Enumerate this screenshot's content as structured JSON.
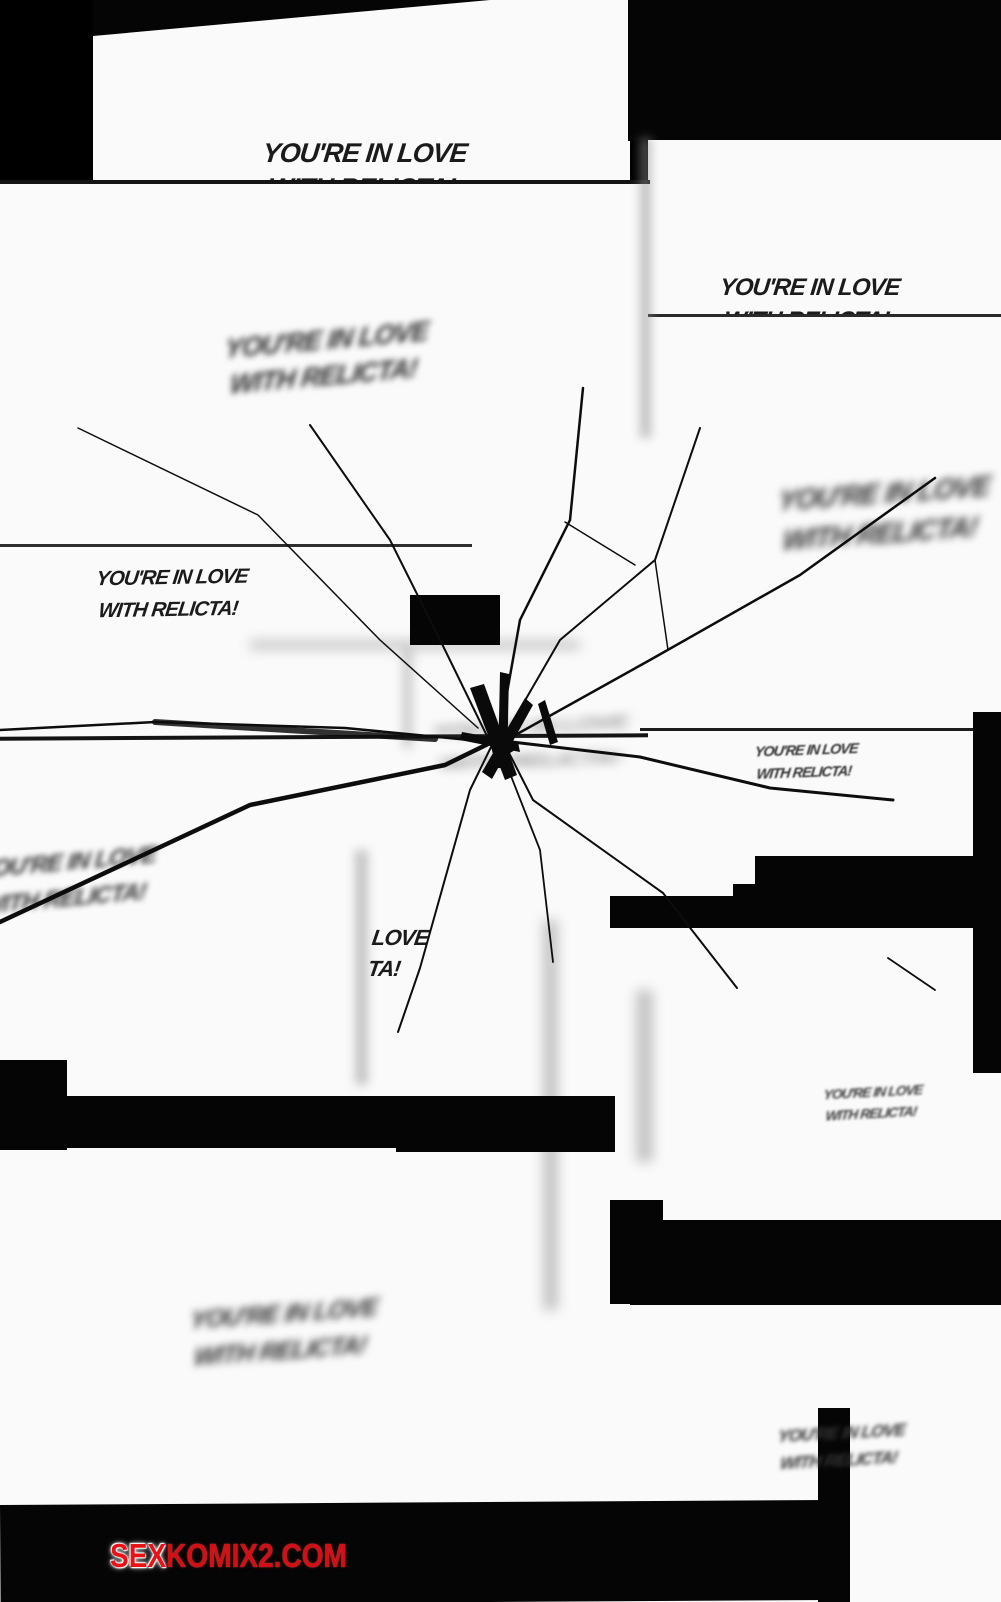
{
  "page": {
    "background_color": "#000000",
    "panel_color": "#fafafa",
    "ink_color": "#141414"
  },
  "speech": {
    "line1": "YOU'RE IN LOVE",
    "line2": "WITH RELICTA!",
    "partial": {
      "line1": "LOVE",
      "line2": "TA!"
    }
  },
  "watermark": {
    "prefix": "SEX",
    "suffix": "KOMIX2.COM",
    "prefix_color": "#e81217",
    "suffix_color": "#d20f15"
  }
}
